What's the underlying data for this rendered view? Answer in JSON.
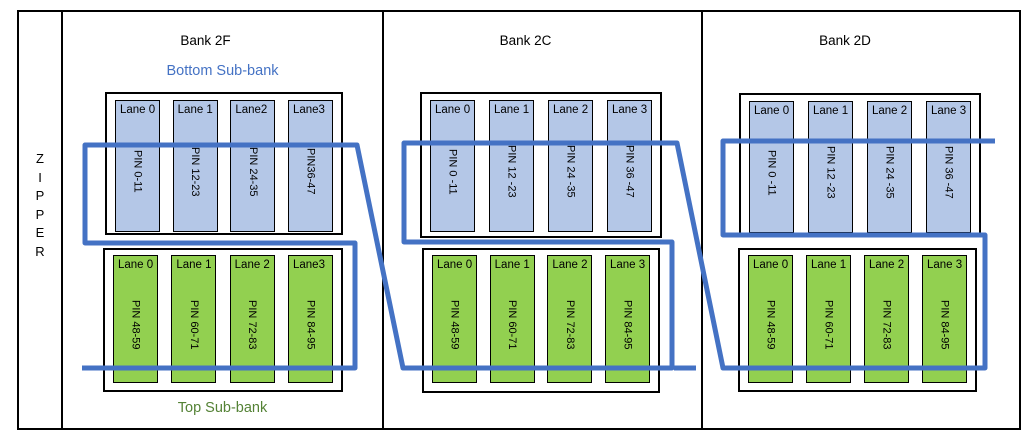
{
  "diagram": {
    "zipper": {
      "letters": [
        "Z",
        "I",
        "P",
        "P",
        "E",
        "R"
      ]
    },
    "subbank_labels": {
      "bottom": "Bottom Sub-bank",
      "top": "Top Sub-bank"
    },
    "banks": [
      {
        "title": "Bank 2F",
        "bottom_subbank": {
          "lanes": [
            {
              "label": "Lane 0",
              "pin": "PIN 0-11"
            },
            {
              "label": "Lane 1",
              "pin": "PIN 12-23"
            },
            {
              "label": "Lane2",
              "pin": "PIN 24-35"
            },
            {
              "label": "Lane3",
              "pin": "PIN36-47"
            }
          ]
        },
        "top_subbank": {
          "lanes": [
            {
              "label": "Lane 0",
              "pin": "PIN 48-59"
            },
            {
              "label": "Lane 1",
              "pin": "PIN 60-71"
            },
            {
              "label": "Lane 2",
              "pin": "PIN 72-83"
            },
            {
              "label": "Lane3",
              "pin": "PIN 84-95"
            }
          ]
        }
      },
      {
        "title": "Bank 2C",
        "bottom_subbank": {
          "lanes": [
            {
              "label": "Lane 0",
              "pin": "PIN 0 -11"
            },
            {
              "label": "Lane 1",
              "pin": "PIN 12 -23"
            },
            {
              "label": "Lane 2",
              "pin": "PIN 24 -35"
            },
            {
              "label": "Lane 3",
              "pin": "PIN 36 -47"
            }
          ]
        },
        "top_subbank": {
          "lanes": [
            {
              "label": "Lane 0",
              "pin": "PIN 48-59"
            },
            {
              "label": "Lane 1",
              "pin": "PIN 60-71"
            },
            {
              "label": "Lane 2",
              "pin": "PIN 72-83"
            },
            {
              "label": "Lane 3",
              "pin": "PIN 84-95"
            }
          ]
        }
      },
      {
        "title": "Bank 2D",
        "bottom_subbank": {
          "lanes": [
            {
              "label": "Lane 0",
              "pin": "PIN 0 -11"
            },
            {
              "label": "Lane 1",
              "pin": "PIN 12 -23"
            },
            {
              "label": "Lane 2",
              "pin": "PIN 24 -35"
            },
            {
              "label": "Lane 3",
              "pin": "PIN 36 -47"
            }
          ]
        },
        "top_subbank": {
          "lanes": [
            {
              "label": "Lane 0",
              "pin": "PIN 48-59"
            },
            {
              "label": "Lane 1",
              "pin": "PIN 60-71"
            },
            {
              "label": "Lane 2",
              "pin": "PIN 72-83"
            },
            {
              "label": "Lane 3",
              "pin": "PIN 84-95"
            }
          ]
        }
      }
    ],
    "colors": {
      "lane_blue": "#B4C7E7",
      "lane_green": "#92D050",
      "zipper_line": "#4472C4",
      "bottom_subbank_text": "#4472C4",
      "top_subbank_text": "#548235"
    }
  }
}
